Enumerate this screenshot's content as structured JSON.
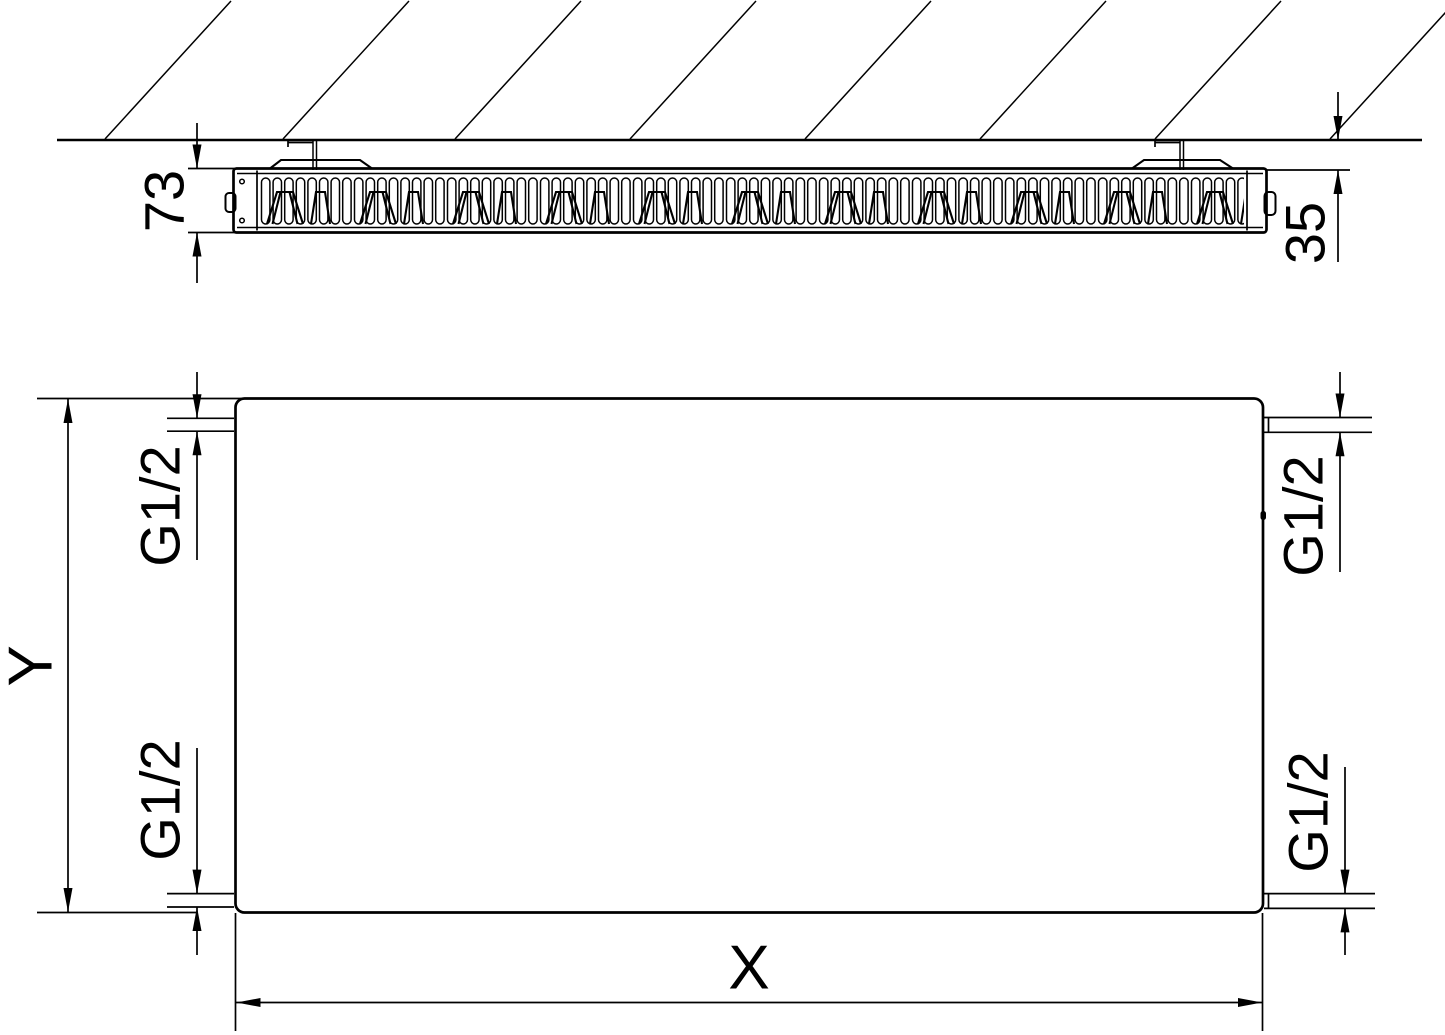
{
  "drawing": {
    "labels": {
      "depth": "73",
      "wall_clearance": "35",
      "height_axis": "Y",
      "width_axis": "X",
      "thread_top_left": "G1/2",
      "thread_bottom_left": "G1/2",
      "thread_top_right": "G1/2",
      "thread_bottom_right": "G1/2"
    },
    "colors": {
      "line": "#000000",
      "background": "#ffffff"
    }
  }
}
